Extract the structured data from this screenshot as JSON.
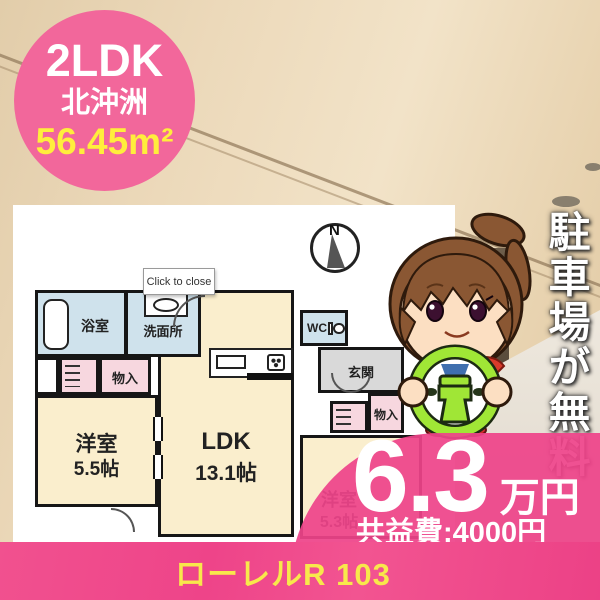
{
  "badge": {
    "layout_type": "2LDK",
    "location": "北沖洲",
    "area": "56.45m²"
  },
  "side_banner": {
    "text": "駐車場が無料"
  },
  "floorplan": {
    "close_button_label": "Click to close",
    "compass_label": "N",
    "rooms": {
      "bath": {
        "label": "浴室"
      },
      "washroom": {
        "label": "洗面所"
      },
      "closet_left": {
        "label": "物入"
      },
      "bedroom_left": {
        "label": "洋室",
        "size": "5.5帖"
      },
      "ldk": {
        "label": "LDK",
        "size": "13.1帖"
      },
      "wc": {
        "label": "WC"
      },
      "entrance": {
        "label": "玄関"
      },
      "closet_right": {
        "label": "物入"
      },
      "bedroom_right": {
        "label": "洋室",
        "size": "5.3帖"
      }
    }
  },
  "price": {
    "amount": "6.3",
    "unit": "万円",
    "common_fee": "共益費:4000円"
  },
  "footer": {
    "property_name": "ローレルR 103"
  },
  "colors": {
    "accent_pink": "#ee4489",
    "badge_pink": "#f2679b",
    "highlight_yellow": "#ffee3c",
    "room_cream": "#faeecd",
    "room_blue": "#cfe2ec",
    "room_pink": "#f7d7df",
    "wheel_green": "#a0e636"
  }
}
